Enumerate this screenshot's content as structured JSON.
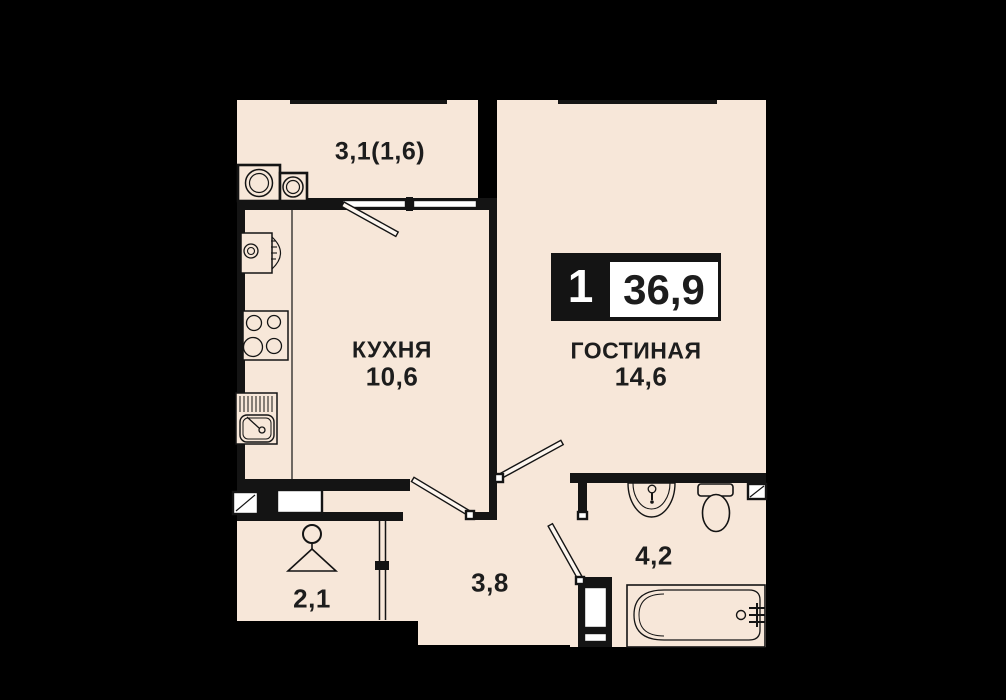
{
  "title": "1-room apartment floor plan",
  "badge": {
    "room_count": "1",
    "total_area": "36,9"
  },
  "rooms": {
    "balcony": {
      "area_label": "3,1(1,6)"
    },
    "kitchen": {
      "name": "КУХНЯ",
      "area": "10,6"
    },
    "living": {
      "name": "ГОСТИНАЯ",
      "area": "14,6"
    },
    "hall": {
      "area": "3,8"
    },
    "wardrobe": {
      "area": "2,1"
    },
    "bathroom": {
      "area": "4,2"
    }
  },
  "colors": {
    "bg": "#000000",
    "floor": "#f7e7d9",
    "wall": "#141414",
    "text": "#1d1d1d"
  }
}
